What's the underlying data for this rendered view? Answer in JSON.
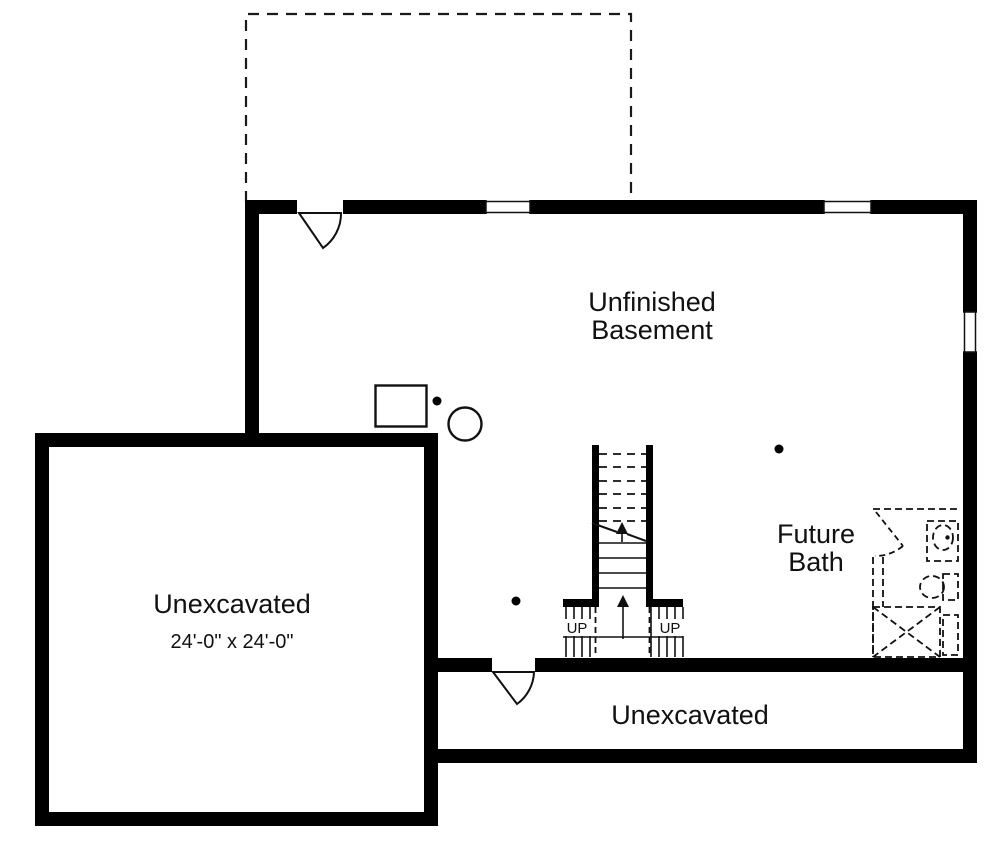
{
  "labels": {
    "basement": {
      "line1": "Unfinished",
      "line2": "Basement"
    },
    "future_bath": {
      "line1": "Future",
      "line2": "Bath"
    },
    "unexcavated_main": {
      "label": "Unexcavated",
      "dimensions": "24'-0\" x 24'-0\""
    },
    "unexcavated_strip": {
      "label": "Unexcavated"
    },
    "stairs": {
      "up_left": "UP",
      "up_right": "UP"
    }
  },
  "colors": {
    "wall": "#000000",
    "line": "#111111",
    "background": "#ffffff"
  }
}
